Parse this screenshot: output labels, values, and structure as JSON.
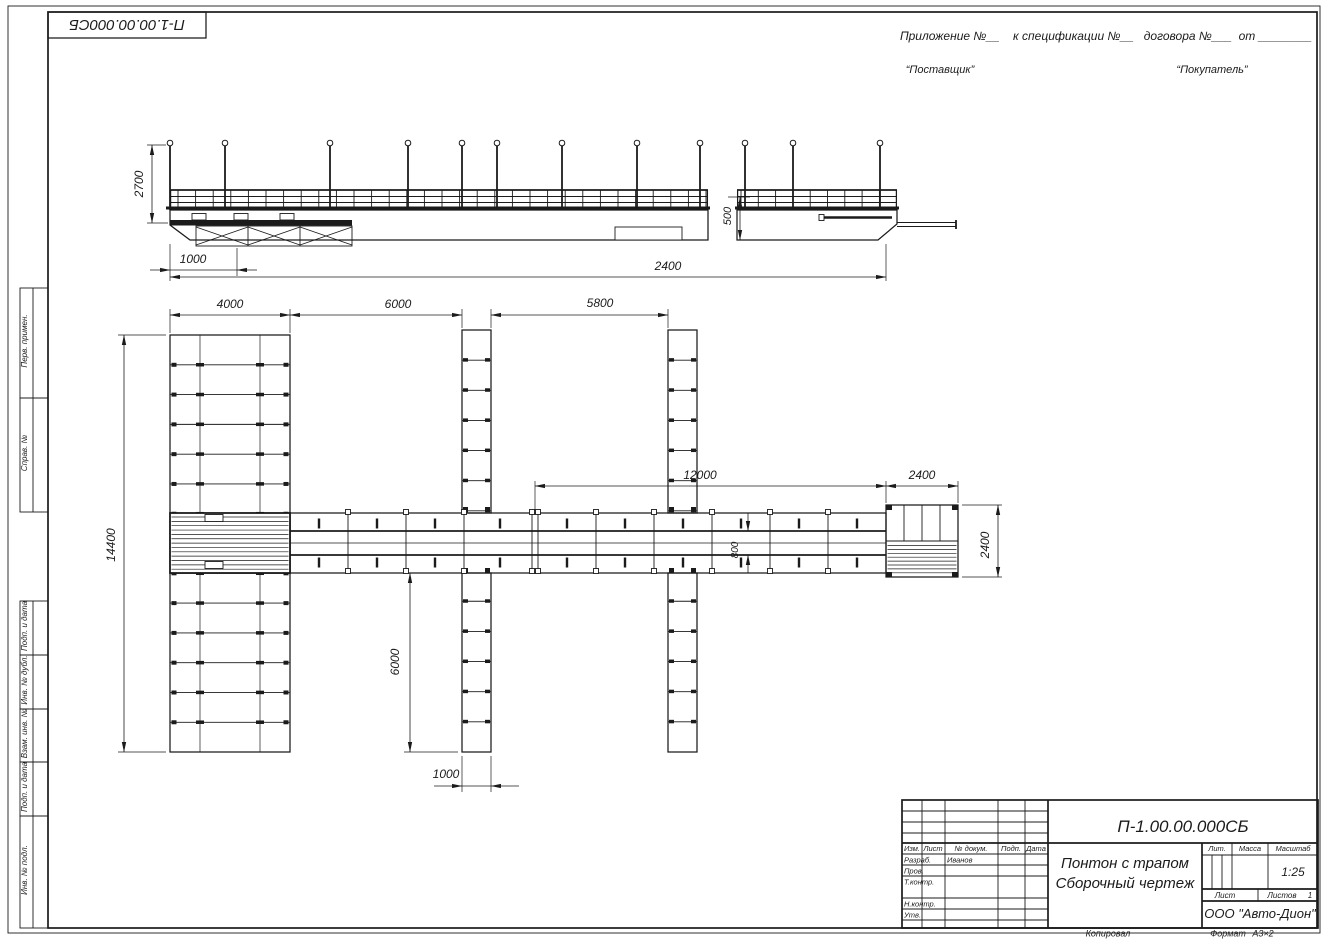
{
  "page": {
    "corner_stamp": "П-1.00.00.000СБ",
    "top_right": {
      "line1": "Приложение №__    к спецификации №__   договора №___  от ________",
      "supplier": "“Поставщик”",
      "buyer": "“Покупатель”"
    },
    "footer": {
      "copied": "Копировал",
      "format_label": "Формат",
      "format_value": "А3×2"
    }
  },
  "side_margin_labels": [
    "Перв. примен.",
    "Справ. №",
    "Подп. и дата",
    "Инв. № дубл.",
    "Взам. инв. №",
    "Подп. и дата",
    "Инв. № подл."
  ],
  "side_view": {
    "dims": {
      "d2700": "2700",
      "d1000": "1000",
      "d500": "500",
      "d2400": "2400"
    }
  },
  "plan_view": {
    "dims": {
      "d4000": "4000",
      "d6000_bay": "6000",
      "d5800": "5800",
      "d12000": "12000",
      "d2400_len": "2400",
      "d14400": "14400",
      "d6000_finger": "6000",
      "d1000_width": "1000",
      "d800": "800",
      "d2400_width": "2400"
    }
  },
  "title_block": {
    "doc_number": "П-1.00.00.000СБ",
    "title_line1": "Понтон с трапом",
    "title_line2": "Сборочный чертеж",
    "columns": [
      "Изм.",
      "Лист",
      "№ докум.",
      "Подп.",
      "Дата"
    ],
    "rows": [
      {
        "label": "Разраб.",
        "value": "Иванов"
      },
      {
        "label": "Пров.",
        "value": ""
      },
      {
        "label": "Т.контр.",
        "value": ""
      },
      {
        "label": "Н.контр.",
        "value": ""
      },
      {
        "label": "Утв.",
        "value": ""
      }
    ],
    "lit_label": "Лит.",
    "mass_label": "Масса",
    "scale_label": "Масштаб",
    "scale_value": "1:25",
    "sheet_label": "Лист",
    "sheets_label": "Листов",
    "sheets_value": "1",
    "company": "ООО \"Авто-Дион\""
  }
}
